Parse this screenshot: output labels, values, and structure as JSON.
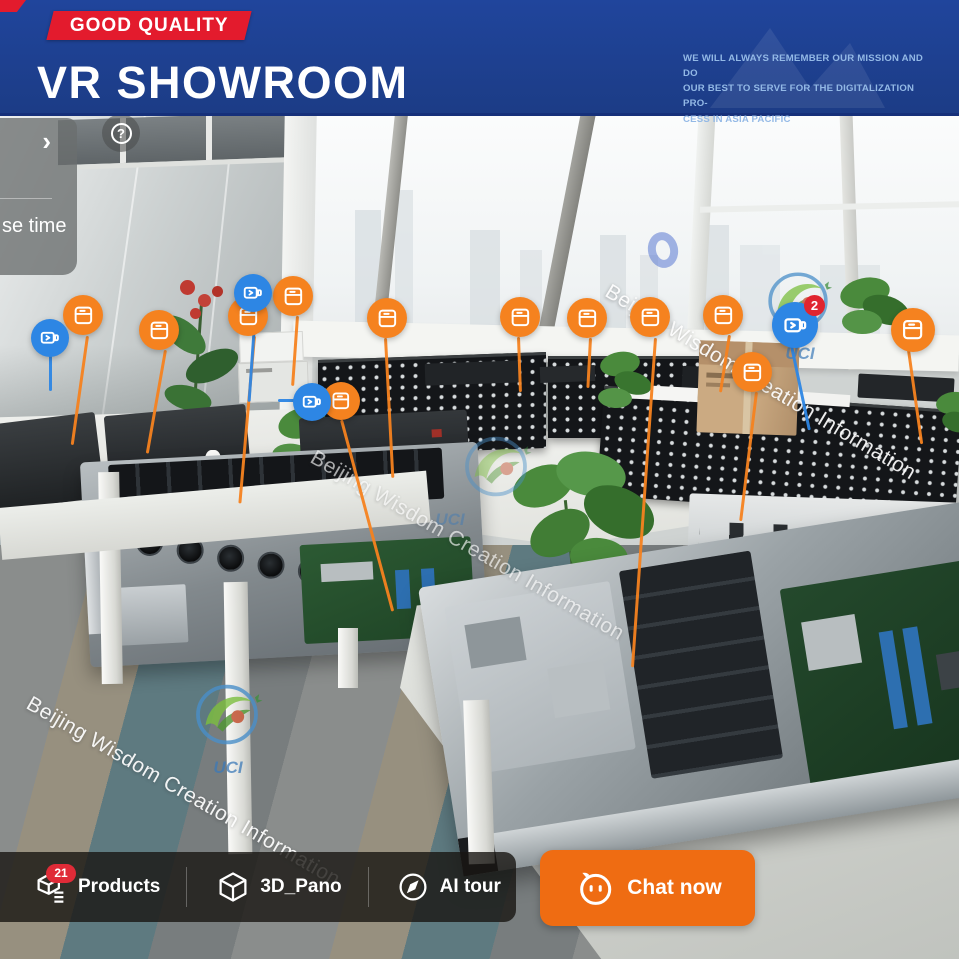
{
  "header": {
    "ribbon": "GOOD QUALITY",
    "title": "VR SHOWROOM",
    "mission": [
      "WE WILL ALWAYS REMEMBER OUR MISSION AND DO",
      "OUR BEST TO SERVE FOR THE DIGITALIZATION PRO-",
      "CESS IN ASIA PACIFIC"
    ],
    "bg_color": "#1e4093",
    "ribbon_color": "#e31b2d"
  },
  "side_panel": {
    "visible_text": "se time"
  },
  "help": {
    "glyph": "?"
  },
  "watermark": {
    "text": "Beijing Wisdom Creation Information",
    "logo_text": "UCI"
  },
  "hotspots": {
    "product_color": "#f5821f",
    "video_color": "#2d86e4",
    "video_badge_count": "2",
    "product_hotspot_count": 12,
    "video_hotspot_count": 4
  },
  "bottom_bar": {
    "products_label": "Products",
    "products_badge": "21",
    "pano_label": "3D_Pano",
    "ai_tour_label": "AI tour",
    "chat_label": "Chat now",
    "chat_color": "#ef6c12"
  }
}
